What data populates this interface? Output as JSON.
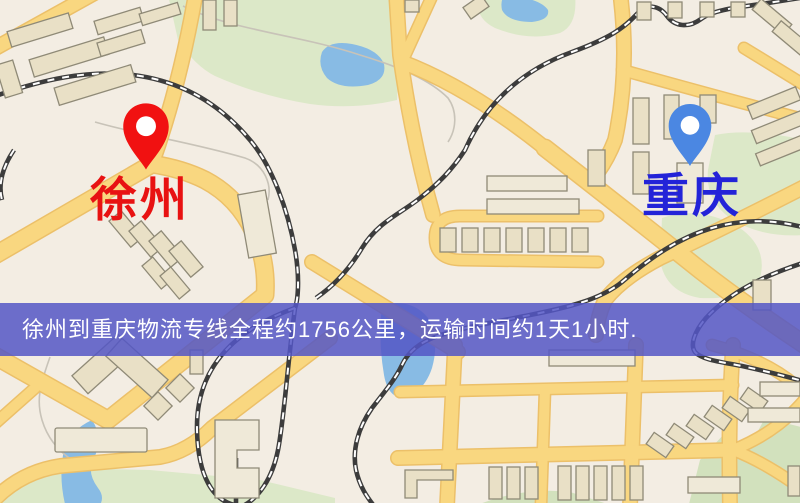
{
  "markers": {
    "origin": {
      "label": "徐州",
      "text_color": "#e81212",
      "pin_color": "#f11111",
      "pin_icon": "red-map-pin-icon"
    },
    "destination": {
      "label": "重庆",
      "text_color": "#2323d8",
      "pin_color": "#4b87e2",
      "pin_icon": "blue-map-pin-icon"
    }
  },
  "banner": {
    "text": "徐州到重庆物流专线全程约1756公里，运输时间约1天1小时.",
    "background_color": "rgba(84,86,198,0.85)",
    "text_color": "#ffffff"
  },
  "map_palette": {
    "background": "#f3ede3",
    "road": "#f9d780",
    "road_casing": "#ecc069",
    "building": "#e9e0c6",
    "building_outline": "#8f8a77",
    "park": "#dce8c8",
    "water": "#88bbe4",
    "railway": "#3c3c3c"
  }
}
